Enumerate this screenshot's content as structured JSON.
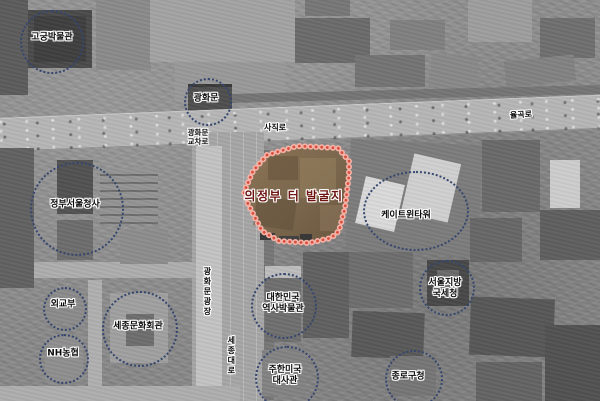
{
  "colors": {
    "circle": "#35466f",
    "excavation_outline": "#d94f3e",
    "excavation_outline_halo": "#f5b3a8",
    "excavation_label": "#6d1410"
  },
  "excavation": {
    "label": "의정부 터 발굴지"
  },
  "places": [
    {
      "id": "gogung-museum",
      "label": "고궁박물관"
    },
    {
      "id": "gwanghwamun",
      "label": "광화문"
    },
    {
      "id": "government-complex",
      "label": "정부서울청사"
    },
    {
      "id": "k-twin-towers",
      "label": "케이트윈타워"
    },
    {
      "id": "mofa",
      "label": "외교부"
    },
    {
      "id": "sejong-center",
      "label": "세종문화회관"
    },
    {
      "id": "nh-bank",
      "label": "NH농협"
    },
    {
      "id": "history-museum",
      "line1": "대한민국",
      "line2": "역사박물관"
    },
    {
      "id": "us-embassy",
      "line1": "주한미국",
      "line2": "대사관"
    },
    {
      "id": "tax-office",
      "line1": "서울지방",
      "line2": "국세청"
    },
    {
      "id": "jongno-office",
      "label": "종로구청"
    }
  ],
  "streets": [
    {
      "id": "sajik-ro",
      "label": "사직로"
    },
    {
      "id": "yulgok-ro",
      "label": "율곡로"
    },
    {
      "id": "gwanghwamun-intersection",
      "line1": "광화문",
      "line2": "교차로"
    },
    {
      "id": "gwanghwamun-square",
      "label": "광화문광장"
    },
    {
      "id": "sejong-daero",
      "label": "세종대로"
    }
  ]
}
